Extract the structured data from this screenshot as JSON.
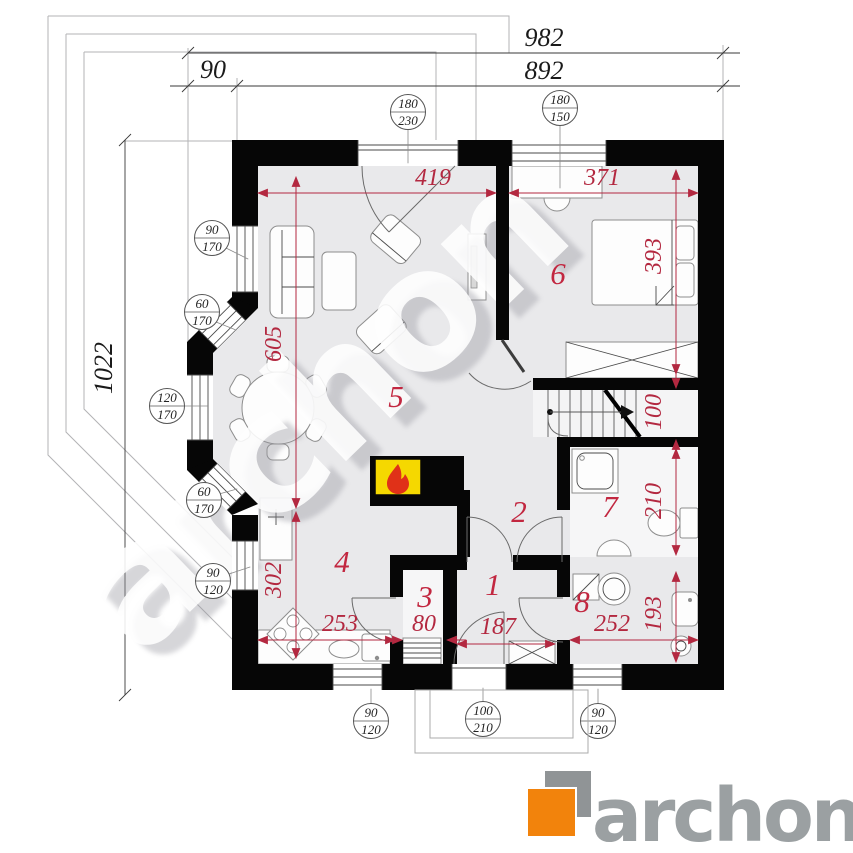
{
  "watermark": {
    "text": "archon"
  },
  "logo": {
    "text": "archon",
    "orange": "#f2830c",
    "gray": "#909496"
  },
  "colors": {
    "dimension_red": "#b32840",
    "floor_gray": "#e9e9eb",
    "wall_black": "#060606",
    "fireplace_yellow": "#f5d800",
    "flame_red": "#e03118"
  },
  "exterior_dims": {
    "top_total": "982",
    "top_inner": "892",
    "top_left_segment": "90",
    "left_total": "1022"
  },
  "interior_dims": {
    "living_width": "419",
    "bedroom_width": "371",
    "bedroom_depth": "393",
    "living_depth": "605",
    "stairs_width": "100",
    "bathroom_depth": "210",
    "utility_depth": "193",
    "kitchen_depth": "302",
    "kitchen_width": "253",
    "pantry_width": "80",
    "hall_width": "187",
    "utility_width": "252"
  },
  "rooms": {
    "hall": "1",
    "corridor": "2",
    "pantry": "3",
    "kitchen": "4",
    "living_room": "5",
    "bedroom": "6",
    "bathroom": "7",
    "utility": "8"
  },
  "openings": {
    "balcony_door": {
      "width": "180",
      "height": "230"
    },
    "bedroom_window": {
      "width": "180",
      "height": "150"
    },
    "left_window": {
      "width": "90",
      "height": "170"
    },
    "bay_upper_window": {
      "width": "60",
      "height": "170"
    },
    "bay_window": {
      "width": "120",
      "height": "170"
    },
    "bay_lower_window": {
      "width": "60",
      "height": "170"
    },
    "kitchen_left_window": {
      "width": "90",
      "height": "120"
    },
    "kitchen_bottom_window": {
      "width": "90",
      "height": "120"
    },
    "front_door": {
      "width": "100",
      "height": "210"
    },
    "utility_window": {
      "width": "90",
      "height": "120"
    }
  }
}
